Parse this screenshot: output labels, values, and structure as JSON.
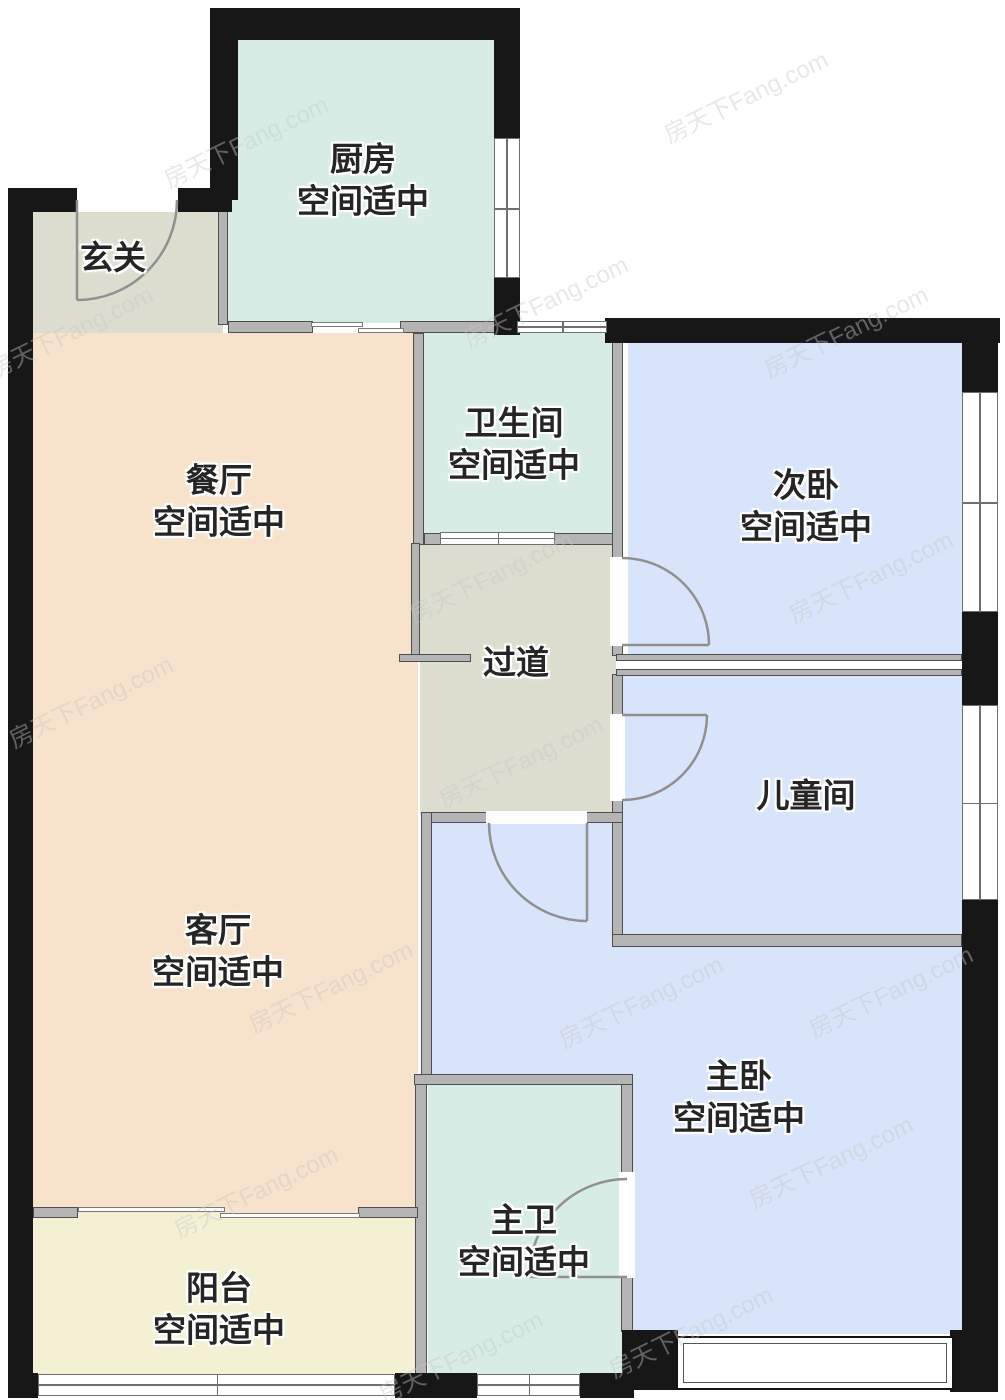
{
  "plan": {
    "width": 1005,
    "height": 1400,
    "colors": {
      "teal": "#d7ece4",
      "gray_green": "#dcddcf",
      "peach": "#f7e2cb",
      "blue": "#d7e4f9",
      "yellow": "#f3f0d4",
      "wall_dark": "#171717",
      "wall_gray": "#b4b4b4"
    },
    "rooms": [
      {
        "id": "kitchen",
        "name": "厨房",
        "subtitle": "空间适中",
        "color": "teal",
        "label": {
          "x": 363,
          "y": 180
        },
        "rects": [
          {
            "x": 228,
            "y": 40,
            "w": 266,
            "h": 283
          }
        ]
      },
      {
        "id": "entry",
        "name": "玄关",
        "subtitle": "",
        "color": "gray_green",
        "label": {
          "x": 113,
          "y": 258
        },
        "rects": [
          {
            "x": 33,
            "y": 212,
            "w": 190,
            "h": 121
          }
        ]
      },
      {
        "id": "dining",
        "name": "餐厅",
        "subtitle": "空间适中",
        "color": "peach",
        "label": {
          "x": 219,
          "y": 501
        },
        "rects": []
      },
      {
        "id": "bathroom",
        "name": "卫生间",
        "subtitle": "空间适中",
        "color": "teal",
        "label": {
          "x": 514,
          "y": 444
        },
        "rects": [
          {
            "x": 424,
            "y": 333,
            "w": 191,
            "h": 202
          }
        ]
      },
      {
        "id": "bedroom2",
        "name": "次卧",
        "subtitle": "空间适中",
        "color": "blue",
        "label": {
          "x": 806,
          "y": 506
        },
        "rects": [
          {
            "x": 628,
            "y": 343,
            "w": 334,
            "h": 315
          }
        ]
      },
      {
        "id": "corridor",
        "name": "过道",
        "subtitle": "",
        "color": "gray_green",
        "label": {
          "x": 516,
          "y": 663
        },
        "rects": [
          {
            "x": 420,
            "y": 543,
            "w": 196,
            "h": 272
          }
        ]
      },
      {
        "id": "kids",
        "name": "儿童间",
        "subtitle": "",
        "color": "blue",
        "label": {
          "x": 806,
          "y": 796
        },
        "rects": [
          {
            "x": 618,
            "y": 670,
            "w": 344,
            "h": 268
          }
        ]
      },
      {
        "id": "living",
        "name": "客厅",
        "subtitle": "空间适中",
        "color": "peach",
        "label": {
          "x": 218,
          "y": 951
        },
        "rects": [
          {
            "x": 33,
            "y": 333,
            "w": 385,
            "h": 880
          }
        ]
      },
      {
        "id": "master",
        "name": "主卧",
        "subtitle": "空间适中",
        "color": "blue",
        "label": {
          "x": 739,
          "y": 1097
        },
        "rects": [
          {
            "x": 425,
            "y": 820,
            "w": 197,
            "h": 263
          },
          {
            "x": 615,
            "y": 944,
            "w": 347,
            "h": 390
          }
        ]
      },
      {
        "id": "masterbath",
        "name": "主卫",
        "subtitle": "空间适中",
        "color": "teal",
        "label": {
          "x": 524,
          "y": 1241
        },
        "rects": [
          {
            "x": 428,
            "y": 1083,
            "w": 198,
            "h": 296
          }
        ]
      },
      {
        "id": "balcony",
        "name": "阳台",
        "subtitle": "空间适中",
        "color": "yellow",
        "label": {
          "x": 219,
          "y": 1309
        },
        "rects": [
          {
            "x": 33,
            "y": 1213,
            "w": 385,
            "h": 166
          }
        ]
      }
    ],
    "watermark": {
      "text": "房天下Fang.com",
      "positions": [
        [
          70,
          330
        ],
        [
          245,
          140
        ],
        [
          745,
          95
        ],
        [
          545,
          300
        ],
        [
          845,
          330
        ],
        [
          90,
          700
        ],
        [
          330,
          985
        ],
        [
          490,
          575
        ],
        [
          520,
          760
        ],
        [
          870,
          575
        ],
        [
          640,
          1000
        ],
        [
          890,
          990
        ],
        [
          255,
          1190
        ],
        [
          690,
          1330
        ],
        [
          460,
          1355
        ],
        [
          830,
          1160
        ]
      ]
    }
  }
}
